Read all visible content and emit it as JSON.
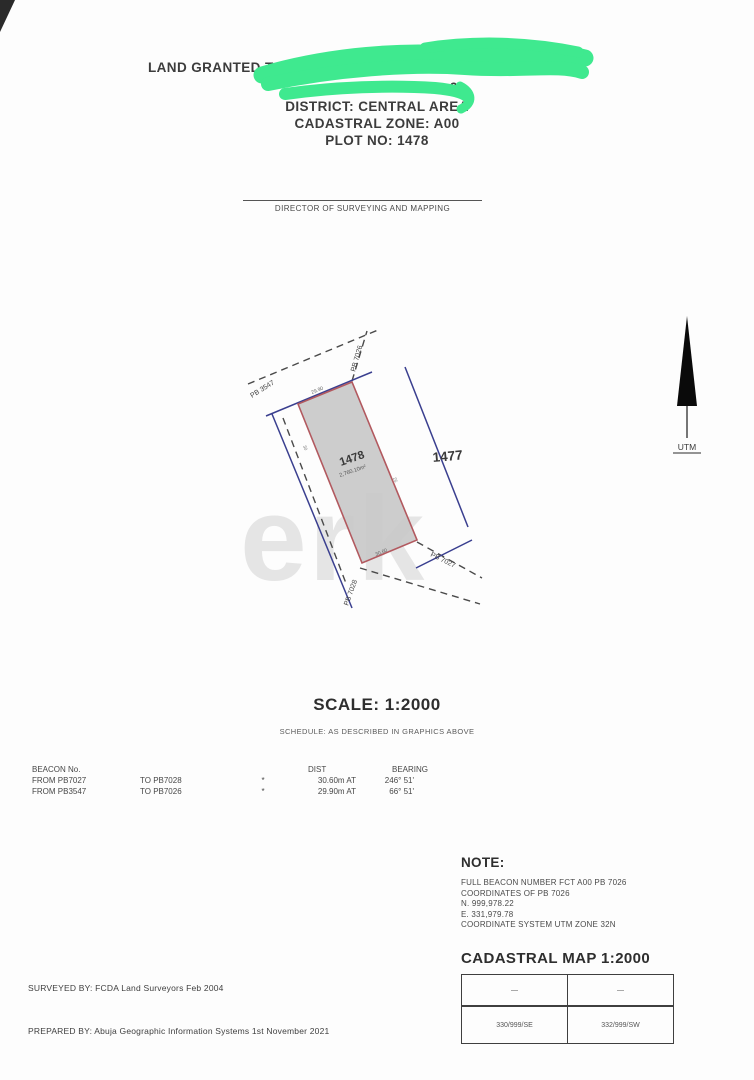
{
  "header": {
    "granted_line": "LAND GRANTED TO",
    "covered_fragment": "9",
    "district": "DISTRICT: CENTRAL AREA",
    "cadastral_zone": "CADASTRAL ZONE: A00",
    "plot_no": "PLOT NO: 1478"
  },
  "signature": {
    "title": "DIRECTOR OF SURVEYING AND MAPPING"
  },
  "compass": {
    "label": "UTM"
  },
  "diagram": {
    "plot_number": "1478",
    "plot_area": "2,760.10m²",
    "adjacent_plot": "1477",
    "beacon_top_left": "PB 3547",
    "beacon_top_right": "PB 7026",
    "beacon_bottom_right": "PB 7027",
    "beacon_bottom_left": "PB 7028",
    "dim_top": "29.90",
    "dim_bottom": "30.60",
    "mark_left": "30",
    "mark_right": "25",
    "watermark": "erk"
  },
  "scale": {
    "title": "SCALE: 1:2000",
    "schedule": "SCHEDULE: AS DESCRIBED IN GRAPHICS ABOVE"
  },
  "beacon_table": {
    "col_beacon": "BEACON No.",
    "col_dist": "DIST",
    "col_bearing": "BEARING",
    "rows": [
      {
        "from": "FROM PB7027",
        "to": "TO PB7028",
        "sep": "*",
        "dist": "30.60m AT",
        "bearing": "246° 51'"
      },
      {
        "from": "FROM PB3547",
        "to": "TO PB7026",
        "sep": "*",
        "dist": "29.90m AT",
        "bearing": "66° 51'"
      }
    ]
  },
  "note": {
    "title": "NOTE:",
    "lines": [
      "FULL BEACON NUMBER FCT A00 PB 7026",
      "COORDINATES OF PB 7026",
      "N. 999,978.22",
      "E. 331,979.78",
      "COORDINATE SYSTEM UTM ZONE 32N"
    ]
  },
  "cadastral_map": {
    "title": "CADASTRAL MAP 1:2000",
    "r1c1": "—",
    "r1c2": "—",
    "r2c1": "330/999/SE",
    "r2c2": "332/999/SW"
  },
  "footer": {
    "surveyed": "SURVEYED BY: FCDA Land Surveyors  Feb 2004",
    "prepared": "PREPARED BY: Abuja Geographic Information Systems  1st November 2021"
  },
  "colors": {
    "redaction": "#3FE98F",
    "plot_fill": "#c9c9c9",
    "plot_stroke": "#b2595f",
    "boundary_blue": "#3a3f8f"
  }
}
